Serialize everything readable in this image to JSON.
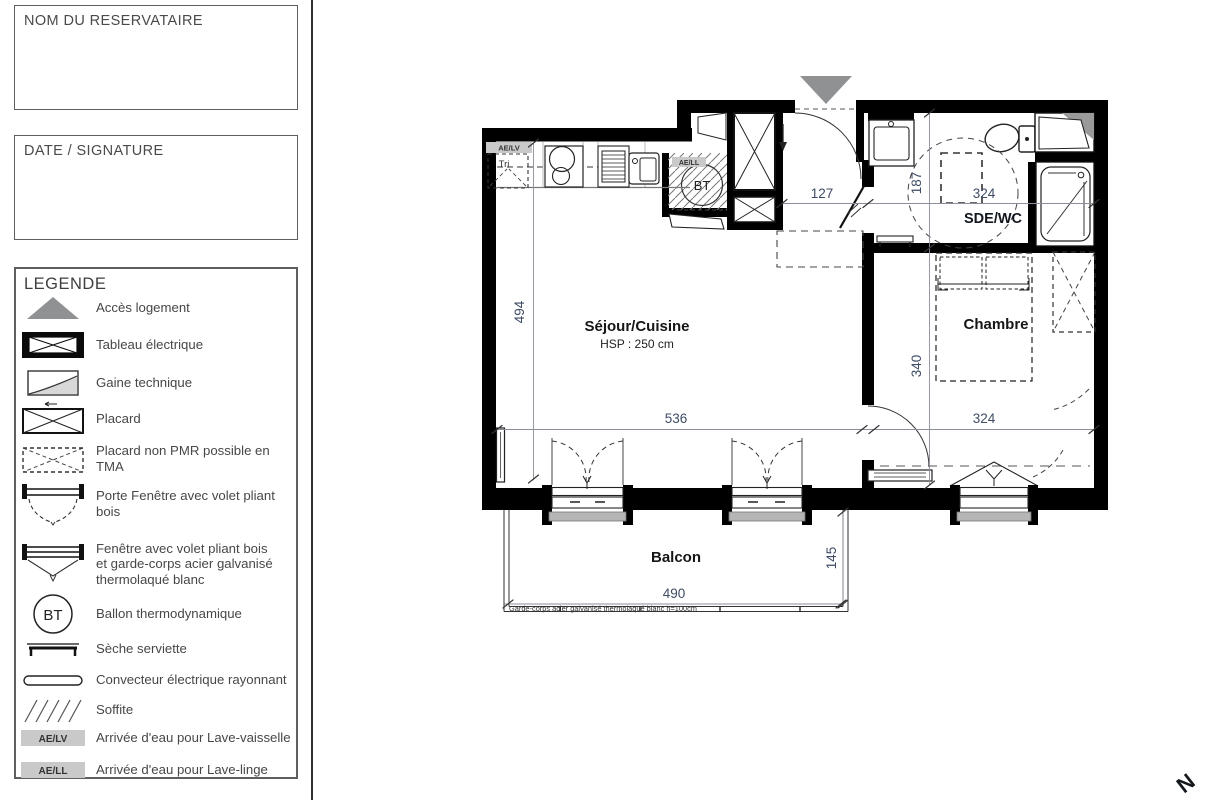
{
  "panel": {
    "reservataire_label": "NOM DU RESERVATAIRE",
    "date_signature_label": "DATE / SIGNATURE",
    "legend": {
      "title": "LEGENDE",
      "items": [
        {
          "name": "acces-logement",
          "label": "Accès logement"
        },
        {
          "name": "tableau-electrique",
          "label": "Tableau électrique"
        },
        {
          "name": "gaine-technique",
          "label": "Gaine technique"
        },
        {
          "name": "placard",
          "label": "Placard"
        },
        {
          "name": "placard-non-pmr",
          "label": "Placard non PMR possible en TMA"
        },
        {
          "name": "porte-fenetre",
          "label": "Porte Fenêtre avec volet pliant bois"
        },
        {
          "name": "fenetre-garde-corps",
          "label": "Fenêtre avec volet pliant bois\net garde-corps acier galvanisé\nthermolaqué blanc"
        },
        {
          "name": "ballon-thermodynamique",
          "label": "Ballon thermodynamique",
          "icon_text": "BT"
        },
        {
          "name": "seche-serviette",
          "label": "Sèche serviette"
        },
        {
          "name": "convecteur",
          "label": "Convecteur électrique rayonnant"
        },
        {
          "name": "soffite",
          "label": "Soffite"
        },
        {
          "name": "ae-lv",
          "label": "Arrivée d'eau pour Lave-vaisselle",
          "icon_text": "AE/LV"
        },
        {
          "name": "ae-ll",
          "label": "Arrivée d'eau pour Lave-linge",
          "icon_text": "AE/LL"
        }
      ]
    }
  },
  "plan": {
    "rooms": {
      "sejour": "Séjour/Cuisine",
      "sejour_hsp": "HSP : 250 cm",
      "chambre": "Chambre",
      "sde": "SDE/WC",
      "balcon": "Balcon"
    },
    "dims": {
      "sejour_h": "494",
      "sejour_w": "536",
      "entry_w": "127",
      "sde_h": "187",
      "sde_w": "324",
      "chambre_h": "340",
      "chambre_w": "324",
      "balcon_w": "490",
      "balcon_h": "145"
    },
    "labels": {
      "ae_lv": "AE/LV",
      "ae_ll": "AE/LL",
      "tri": "Tri",
      "bt": "BT",
      "garde_corps": "Garde-corps acier galvanisé thermolaqué blanc h=100cm",
      "north": "N"
    }
  },
  "colors": {
    "wall": "#000000",
    "access_gray": "#8f9193",
    "label_bg": "#c9c9c9",
    "dim_text": "#3e4c66"
  }
}
